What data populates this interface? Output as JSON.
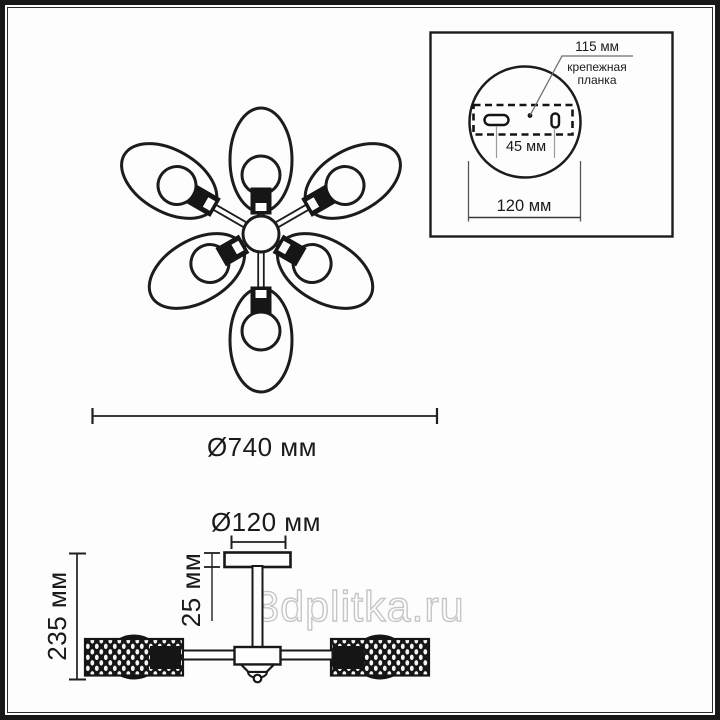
{
  "colors": {
    "ink": "#1c1c1c",
    "leader_gray": "#6e6e6e",
    "ext_line_gray": "#9a9a9a",
    "watermark": "#c6c6c6"
  },
  "watermark": {
    "text": "3dplitka.ru"
  },
  "top_view": {
    "description": "ceiling chandelier, view from below, 6 oval shades in flower arrangement",
    "petal_count": 6,
    "petals": [
      {
        "angle": 0,
        "arm": "short"
      },
      {
        "angle": 60,
        "arm": "long"
      },
      {
        "angle": 120,
        "arm": "short"
      },
      {
        "angle": 180,
        "arm": "long"
      },
      {
        "angle": 240,
        "arm": "short"
      },
      {
        "angle": 300,
        "arm": "long"
      }
    ],
    "dimension": {
      "label": "Ø740 мм"
    }
  },
  "mount_inset": {
    "callout": {
      "dim_label": "115 мм",
      "name_line1": "крепежная",
      "name_line2": "планка"
    },
    "hole_spacing": {
      "label": "45 мм"
    },
    "plate_diameter": {
      "label": "120 мм"
    }
  },
  "side_view": {
    "canopy_diameter": {
      "label": "Ø120 мм"
    },
    "canopy_height": {
      "label": "25 мм"
    },
    "total_height": {
      "label": "235 мм"
    }
  }
}
